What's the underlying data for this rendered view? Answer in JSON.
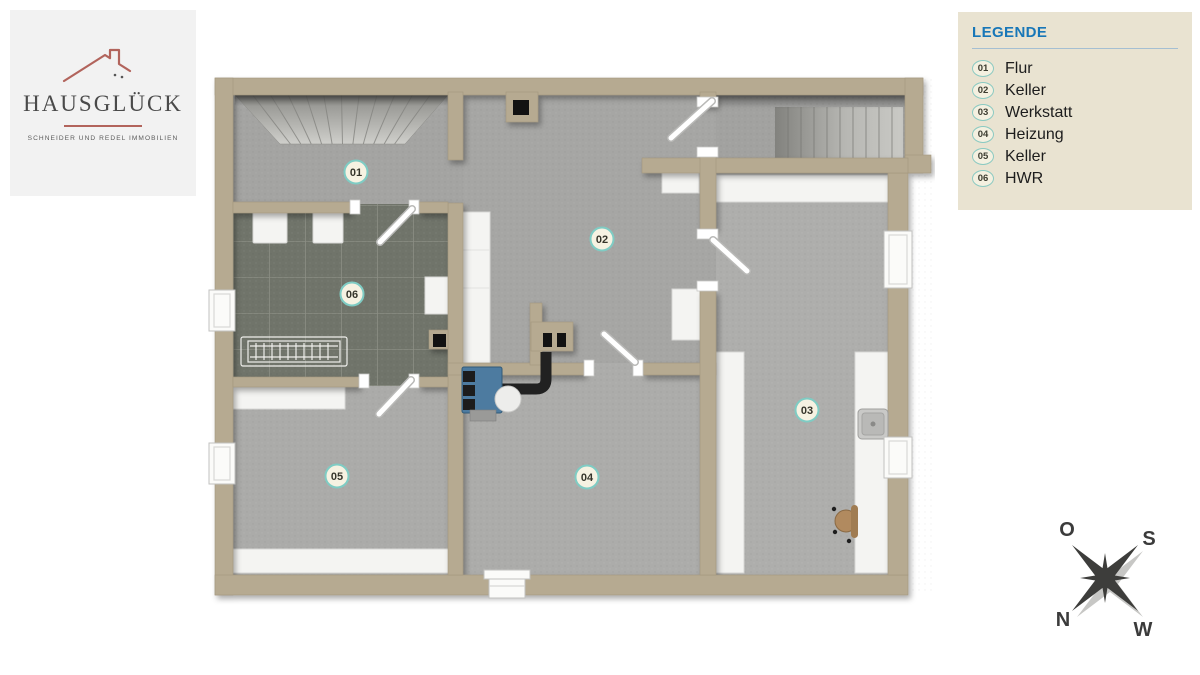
{
  "logo": {
    "title": "HAUSGLÜCK",
    "subtitle": "SCHNEIDER UND REDEL IMMOBILIEN"
  },
  "legend": {
    "title": "LEGENDE",
    "items": [
      {
        "number": "01",
        "label": "Flur"
      },
      {
        "number": "02",
        "label": "Keller"
      },
      {
        "number": "03",
        "label": "Werkstatt"
      },
      {
        "number": "04",
        "label": "Heizung"
      },
      {
        "number": "05",
        "label": "Keller"
      },
      {
        "number": "06",
        "label": "HWR"
      }
    ]
  },
  "floorplan": {
    "rooms": [
      {
        "number": "01",
        "name": "Flur"
      },
      {
        "number": "02",
        "name": "Keller"
      },
      {
        "number": "03",
        "name": "Werkstatt"
      },
      {
        "number": "04",
        "name": "Heizung"
      },
      {
        "number": "05",
        "name": "Keller"
      },
      {
        "number": "06",
        "name": "HWR"
      }
    ]
  },
  "compass": {
    "top_left": "O",
    "top_right": "S",
    "bottom_left": "N",
    "bottom_right": "W"
  },
  "colors": {
    "legend_title": "#1877b8",
    "legend_bg": "#e9e3d1",
    "badge_ring": "#7fccc4",
    "wall": "#b6aa91",
    "floor": "#a8a8a6",
    "tile_floor": "#70746a",
    "logo_accent": "#b2645c",
    "heater": "#4d7ba0"
  }
}
